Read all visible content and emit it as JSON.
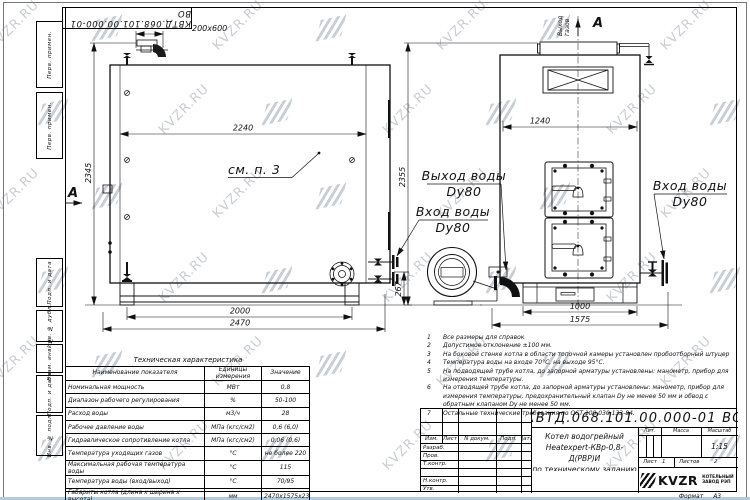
{
  "watermark": {
    "text": "KVZR.RU",
    "color": "#c9cdd4"
  },
  "doc": {
    "number": "КВТД.068.101.00.000-01 ВО"
  },
  "sidebar": {
    "items": [
      "Перв. примен.",
      "Перв. примен.",
      "Подп. и дата",
      "Инв. № дубл.",
      "Взам. инв. №",
      "Подп. и дата",
      "Инв. № подл."
    ]
  },
  "drawing": {
    "dims": {
      "flue_w": "200x600",
      "side_inner_w": "2240",
      "side_h": "2345",
      "side_base_w": "2000",
      "side_overall_w": "2470",
      "inlet_h": "267",
      "front_inner_w": "1240",
      "front_h": "2355",
      "front_base_w": "1000",
      "front_overall_w": "1575"
    },
    "labels": {
      "section_a_left": "А",
      "section_a_top": "А",
      "see_note": "см. п. 3",
      "gas_out_1": "Выход",
      "gas_out_2": "газов",
      "water_out": "Выход воды",
      "water_out_dn": "Dy80",
      "water_in_left": "Вход воды",
      "water_in_left_dn": "Dy80",
      "water_in_right": "Вход воды",
      "water_in_right_dn": "Dy80"
    }
  },
  "notes": {
    "items": [
      {
        "n": "1",
        "text": "Все размеры для справок"
      },
      {
        "n": "2",
        "text": "Допустимое отклонение ±100 мм."
      },
      {
        "n": "3",
        "text": "На боковой стенке котла в области топочной камеры установлен пробоотборный штуцер"
      },
      {
        "n": "4",
        "text": "Температура воды на входе 70°С, на выходе 95°С."
      },
      {
        "n": "5",
        "text": "На подводящей трубе котла, до запорной арматуры установлены: манометр, прибор для измерения температуры."
      },
      {
        "n": "6",
        "text": "На отводящей трубе котла, до запорной арматуры установлены: манометр, прибор для измерения температуры, предохранительный клапан Dу не менее 50 мм и обвод с обратным клапаном Dу не менее 50 мм."
      },
      {
        "n": "7",
        "text": "Остальные технические требования по ОСТ 108.030.133-84."
      }
    ]
  },
  "spec_table": {
    "title": "Техническая характеристика",
    "headers": [
      "Наименование показателя",
      "Единицы измерения",
      "Значение"
    ],
    "rows": [
      [
        "Номинальная мощность",
        "МВт",
        "0,8"
      ],
      [
        "Диапазон рабочего регулирования",
        "%",
        "50-100"
      ],
      [
        "Расход воды",
        "м3/ч",
        "28"
      ],
      [
        "Рабочее давление воды",
        "МПа (кгс/см2)",
        "0,6 (6,0)"
      ],
      [
        "Гидравлическое сопротивление котла",
        "МПа (кгс/см2)",
        "0,06 (0,6)"
      ],
      [
        "Температура уходящих газов",
        "°С",
        "не более 220"
      ],
      [
        "Максимальная рабочая температура воды",
        "°С",
        "115"
      ],
      [
        "Температура воды (вход/выход)",
        "°С",
        "70/95"
      ],
      [
        "Габариты котла (длина х ширина х высота)",
        "мм",
        "2470х1575х2345"
      ]
    ]
  },
  "title_block": {
    "rev_cols": [
      "Изм.",
      "Лист",
      "N докум.",
      "Подп.",
      "Дата"
    ],
    "sign_rows": [
      "Разраб.",
      "Пров.",
      "Т.контр.",
      "",
      "Н.контр.",
      "Утв."
    ],
    "product_title_lines": [
      "Котел водогрейный",
      "Heatexpert-КВр-0,8-Д(РВР)И",
      "по техническому заданию"
    ],
    "lit_label": "Лит.",
    "mass_label": "Масса",
    "scale_label": "Масштаб",
    "scale": "1:15",
    "sheet_label": "Лист",
    "sheet": "1",
    "sheets_label": "Листов",
    "sheets": "2",
    "logo_text": "KVZR",
    "company_line1": "КОТЕЛЬНЫЙ",
    "company_line2": "ЗАВОД РЭП",
    "format_label": "Формат",
    "format": "А3"
  }
}
